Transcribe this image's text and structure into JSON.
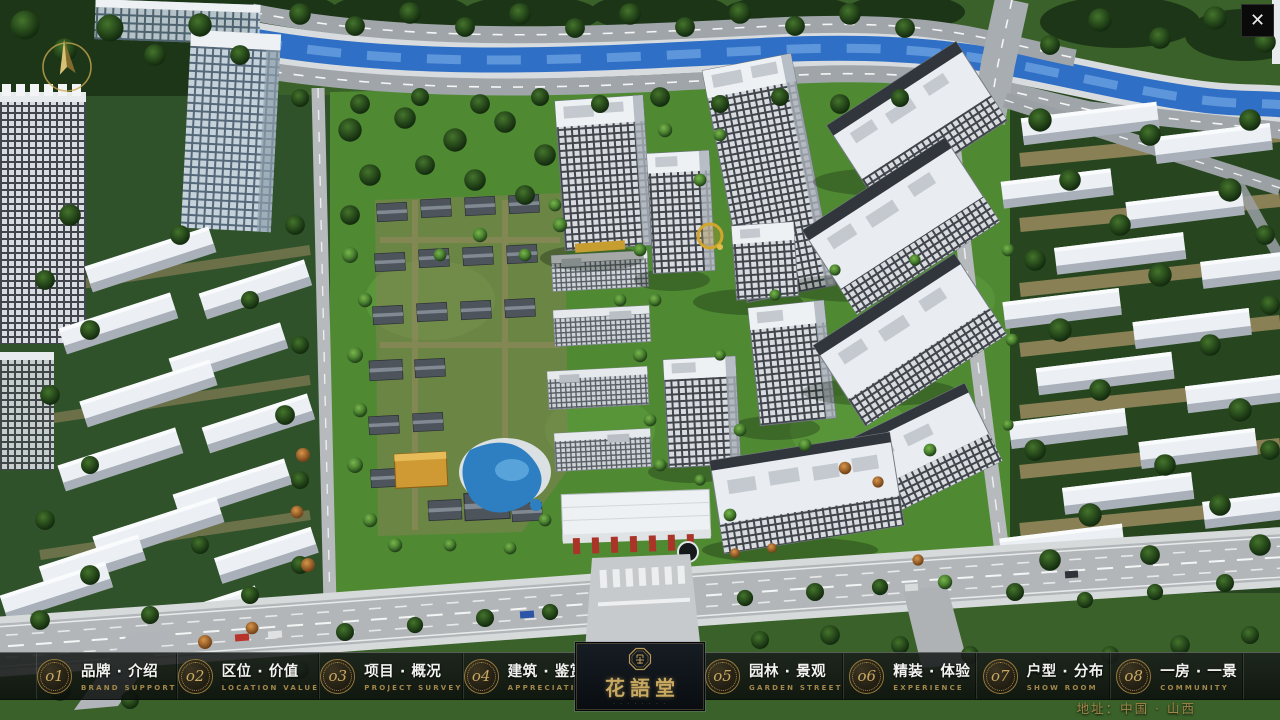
{
  "icons": {
    "close": "✕",
    "compass": "gold-north-arrow",
    "logo_seal": "octagonal-seal"
  },
  "menu": {
    "items": [
      {
        "num": "o1",
        "cn": "品牌 · 介绍",
        "en": "BRAND SUPPORT"
      },
      {
        "num": "o2",
        "cn": "区位 · 价值",
        "en": "LOCATION VALUE"
      },
      {
        "num": "o3",
        "cn": "项目 · 概况",
        "en": "PROJECT SURVEY"
      },
      {
        "num": "o4",
        "cn": "建筑 · 鉴赏",
        "en": "APPRECIATION"
      },
      {
        "num": "o5",
        "cn": "园林 · 景观",
        "en": "GARDEN STREET"
      },
      {
        "num": "o6",
        "cn": "精装 · 体验",
        "en": "EXPERIENCE"
      },
      {
        "num": "o7",
        "cn": "户型 · 分布",
        "en": "SHOW ROOM"
      },
      {
        "num": "o8",
        "cn": "一房 · 一景",
        "en": "COMMUNITY"
      }
    ]
  },
  "logo": {
    "title": "花語堂",
    "tagline": "· · · · · · · ·"
  },
  "footer": {
    "address": "地址：中国 · 山西"
  },
  "colors": {
    "gold": "#c9a860",
    "gold_dim": "#a3874a",
    "menu_text": "#f2f2f0",
    "bar_bg": "rgba(16,20,18,0.84)",
    "logo_panel_bg": "#0d1217"
  }
}
